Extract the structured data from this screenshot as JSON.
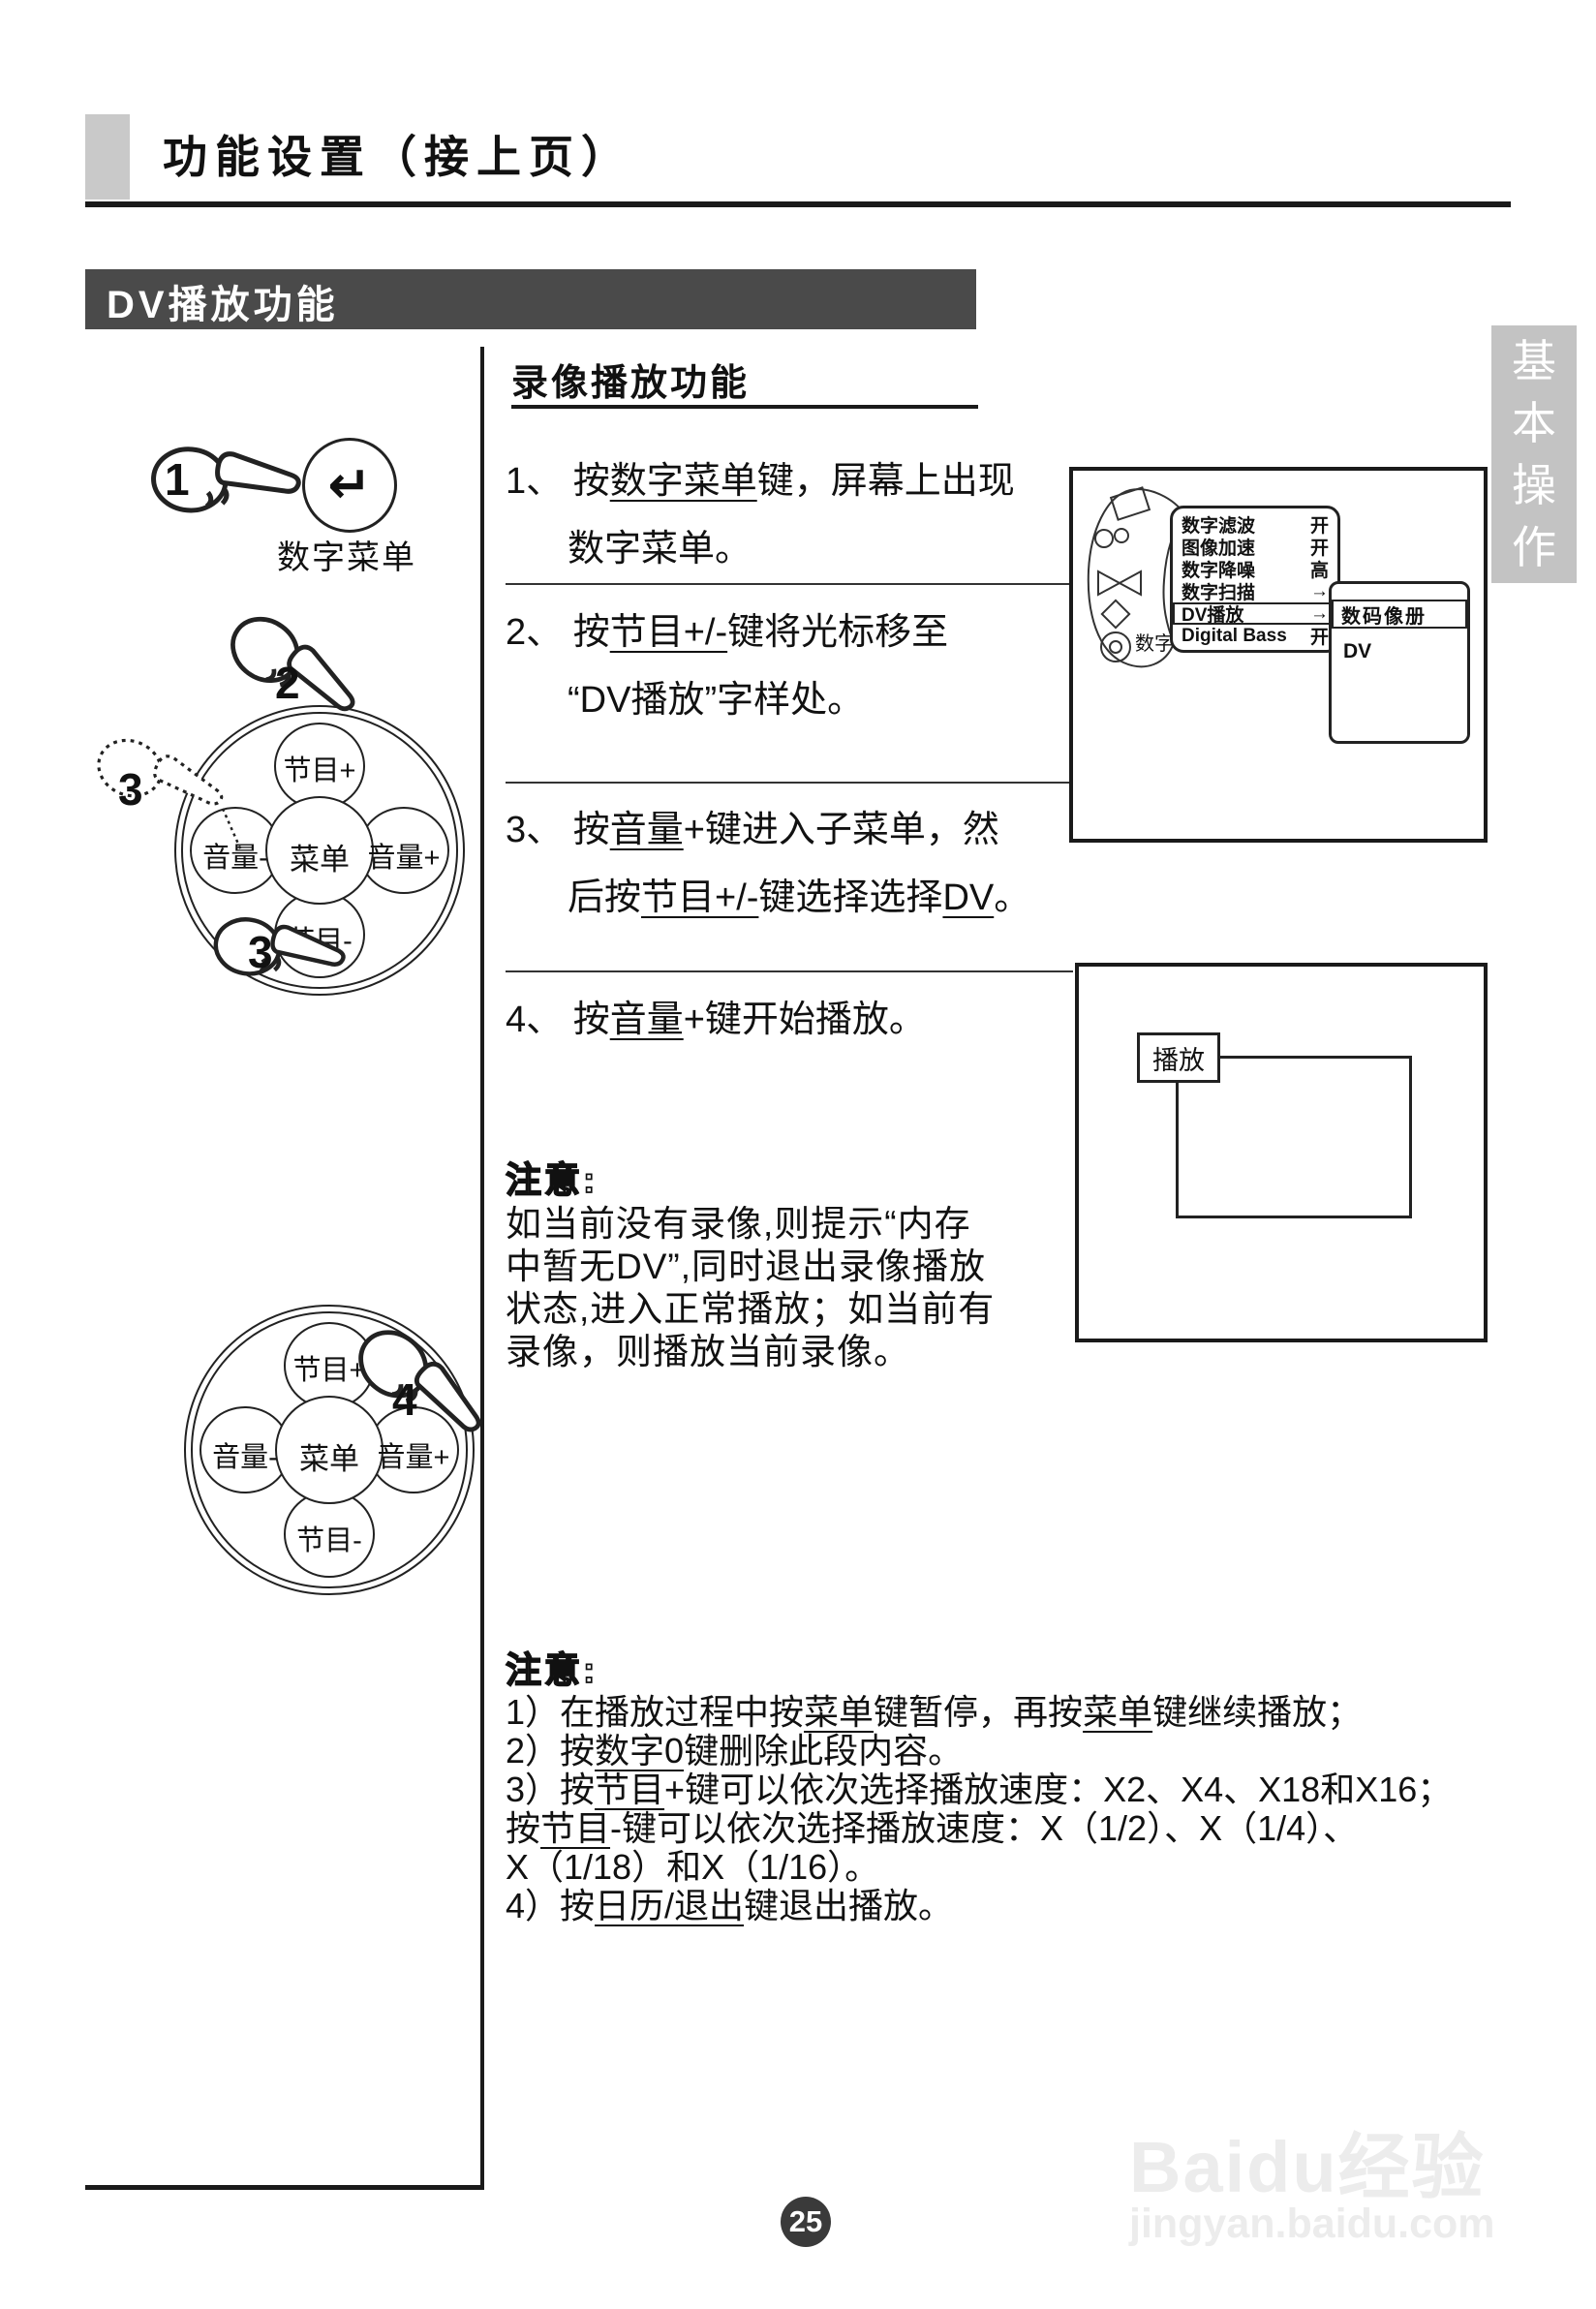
{
  "header": {
    "title": "功能设置（接上页）"
  },
  "banner": {
    "title": "DV播放功能"
  },
  "tab": {
    "chars": [
      "基",
      "本",
      "操",
      "作"
    ]
  },
  "section": {
    "title": "录像播放功能"
  },
  "remote1": {
    "number": "1",
    "key_symbol": "↵",
    "label": "数字菜单"
  },
  "pad": {
    "top": "节目+",
    "left": "音量-",
    "center": "菜单",
    "right": "音量+",
    "bottom": "节目-"
  },
  "callouts": {
    "step2": "2",
    "step3a": "3",
    "step3b": "3",
    "step4": "4"
  },
  "steps": [
    {
      "lines": [
        [
          {
            "t": "1、 按"
          },
          {
            "t": "数字菜单",
            "u": true
          },
          {
            "t": "键，屏幕上出现"
          }
        ],
        [
          {
            "t": "数字菜单。"
          }
        ]
      ]
    },
    {
      "lines": [
        [
          {
            "t": "2、 按"
          },
          {
            "t": "节目+/-",
            "u": true
          },
          {
            "t": "键将光标移至"
          }
        ],
        [
          {
            "t": "“DV播放”字样处。"
          }
        ]
      ]
    },
    {
      "lines": [
        [
          {
            "t": "3、 按"
          },
          {
            "t": "音量",
            "u": true
          },
          {
            "t": "+键进入子菜单，然"
          }
        ],
        [
          {
            "t": "后按"
          },
          {
            "t": "节目+/-",
            "u": true
          },
          {
            "t": "键选择选择"
          },
          {
            "t": "DV",
            "u": true
          },
          {
            "t": "。"
          }
        ]
      ]
    },
    {
      "lines": [
        [
          {
            "t": "4、 按"
          },
          {
            "t": "音量",
            "u": true
          },
          {
            "t": "+键开始播放。"
          }
        ]
      ]
    }
  ],
  "tv1": {
    "sketch_label": "数字",
    "menu": [
      {
        "label": "数字滤波",
        "value": "开"
      },
      {
        "label": "图像加速",
        "value": "开"
      },
      {
        "label": "数字降噪",
        "value": "高"
      },
      {
        "label": "数字扫描",
        "value": "→"
      },
      {
        "label": "DV播放",
        "value": "→"
      },
      {
        "label": "Digital Bass",
        "value": "开"
      }
    ],
    "submenu": {
      "selected": "数码像册",
      "item": "DV"
    }
  },
  "tv2": {
    "osd": "播放"
  },
  "note1": {
    "title": "注意:",
    "lines": [
      "如当前没有录像,则提示“内存",
      "中暂无DV”,同时退出录像播放",
      "状态,进入正常播放；如当前有",
      "录像，则播放当前录像。"
    ]
  },
  "note2": {
    "title": "注意:",
    "lines": [
      [
        {
          "t": "1）在播放过程中按"
        },
        {
          "t": "菜单",
          "u": true
        },
        {
          "t": "键暂停，再按"
        },
        {
          "t": "菜单",
          "u": true
        },
        {
          "t": "键继续播放；"
        }
      ],
      [
        {
          "t": "2）按"
        },
        {
          "t": "数字0",
          "u": true
        },
        {
          "t": "键删除此段内容。"
        }
      ],
      [
        {
          "t": "3）按"
        },
        {
          "t": "节目",
          "u": true
        },
        {
          "t": "+键可以依次选择播放速度：X2、X4、X18和X16；"
        }
      ],
      [
        {
          "t": " 按"
        },
        {
          "t": "节目",
          "u": true
        },
        {
          "t": "-键可以依次选择播放速度：X（1/2）、X（1/4）、"
        }
      ],
      [
        {
          "t": " X（1/18）和X（1/16）。"
        }
      ],
      [
        {
          "t": "4）按"
        },
        {
          "t": "日历/退出",
          "u": true
        },
        {
          "t": "键退出播放。"
        }
      ]
    ]
  },
  "footer": {
    "page_number": "25"
  },
  "watermark": {
    "brand": "Baidu经验",
    "url": "jingyan.baidu.com"
  },
  "colors": {
    "ink": "#1a1a1a",
    "banner_bg": "#4a4a4a",
    "tab_bg": "#c3c3c3",
    "header_square": "#c9c9c9",
    "page_circle": "#3a3a3a",
    "watermark": "#ececec"
  }
}
